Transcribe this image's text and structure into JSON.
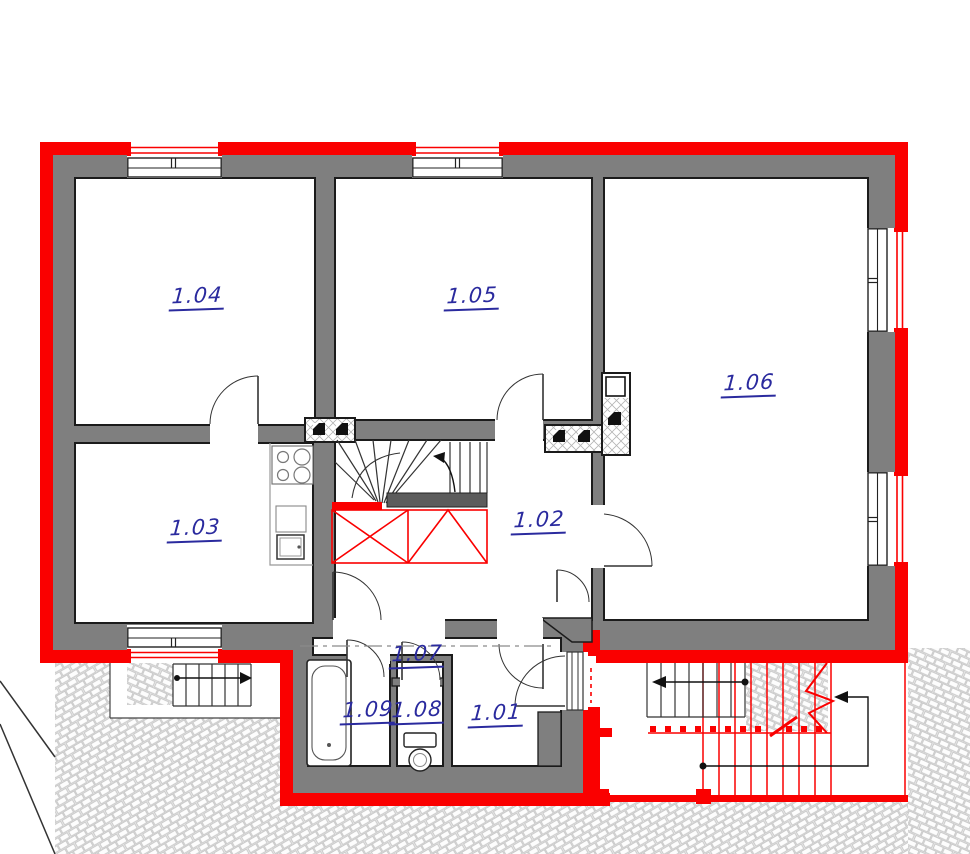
{
  "rooms": [
    {
      "label": "1.01"
    },
    {
      "label": "1.02"
    },
    {
      "label": "1.03"
    },
    {
      "label": "1.04"
    },
    {
      "label": "1.05"
    },
    {
      "label": "1.06"
    },
    {
      "label": "1.07"
    },
    {
      "label": "1.08"
    },
    {
      "label": "1.09"
    }
  ],
  "fixtures": [
    "bathtub",
    "toilet",
    "stove-cooktop",
    "kitchen-sink",
    "interior-winder-staircase",
    "exterior-staircase-left",
    "exterior-staircase-right",
    "chimney-flue",
    "ventilation-shaft",
    "windows",
    "door-swings",
    "cobblestone-paving",
    "section-line"
  ],
  "colors": {
    "new_construction_red": "#fa0000",
    "existing_wall_gray": "#7f7f7f",
    "room_label_blue": "#2a2a9e",
    "drawing_line_black": "#1b1b1b",
    "paving_stone_line": "#c6c6c6",
    "stair_landing_dark": "#5c5c5c"
  }
}
